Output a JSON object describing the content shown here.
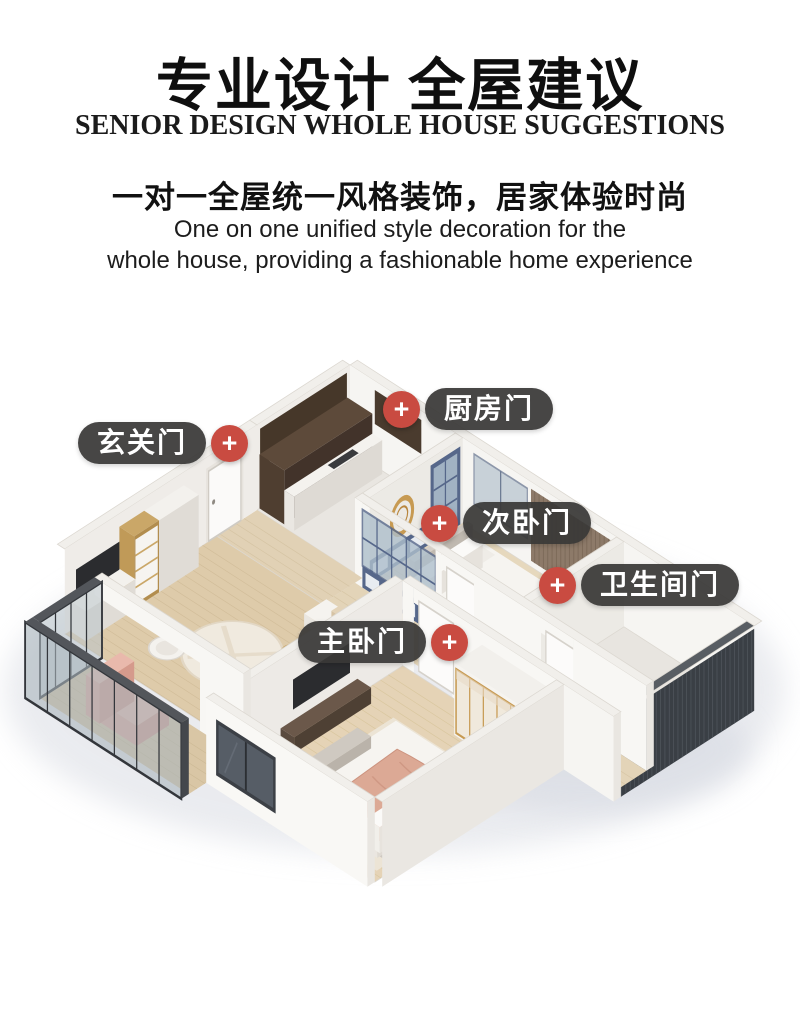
{
  "header": {
    "title": "专业设计 全屋建议",
    "subtitle_en": "SENIOR DESIGN WHOLE HOUSE SUGGESTIONS",
    "tagline": "一对一全屋统一风格装饰，居家体验时尚",
    "tagline_en_line1": "One on one unified style decoration for the",
    "tagline_en_line2": "whole house, providing a fashionable home experience"
  },
  "labels": {
    "marker_glyph": "+",
    "entrance": "玄关门",
    "kitchen": "厨房门",
    "second_bedroom": "次卧门",
    "bathroom": "卫生间门",
    "master_bedroom": "主卧门"
  },
  "colors": {
    "label_bg": "#393837",
    "label_text": "#ffffff",
    "marker_red": "#c94b41",
    "accent_gold": "#c79a52",
    "frame_blue": "#56678a",
    "wood_floor": "#dcc9a8",
    "blanket_pink": "#dca995",
    "dark_glass": "#3a3f45"
  }
}
